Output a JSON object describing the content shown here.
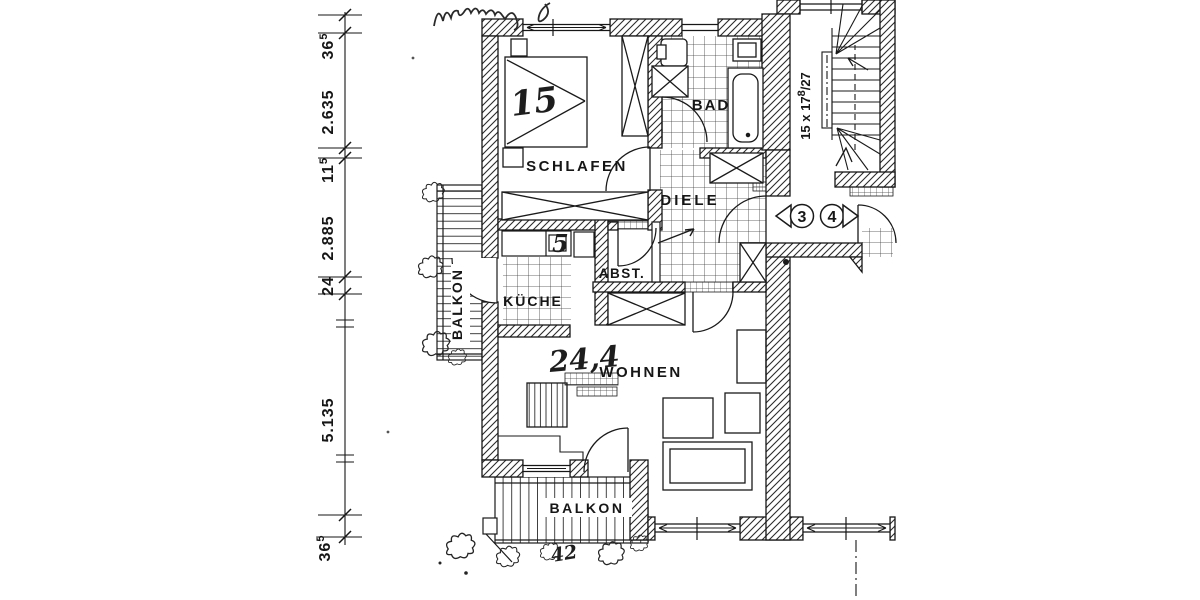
{
  "dimensions": [
    {
      "main": "36",
      "sup": "5"
    },
    {
      "main": "2.635",
      "sup": ""
    },
    {
      "main": "11",
      "sup": "5"
    },
    {
      "main": "2.885",
      "sup": ""
    },
    {
      "main": "24",
      "sup": ""
    },
    {
      "main": "5.135",
      "sup": ""
    },
    {
      "main": "36",
      "sup": "5"
    }
  ],
  "rooms": {
    "schlafen": "SCHLAFEN",
    "bad": "BAD",
    "diele": "DIELE",
    "abst": "ABST.",
    "kueche": "KÜCHE",
    "wohnen": "WOHNEN",
    "balkon_left": "BALKON",
    "balkon_bottom": "BALKON"
  },
  "stairs": {
    "label_main": "15 x 17",
    "label_sup": "8",
    "label_denom": "/27"
  },
  "units": {
    "unit_left": "3",
    "unit_right": "4"
  },
  "annotations": {
    "bed_number": "15",
    "kueche_number": "5",
    "wohnen_area": "24,4",
    "balkon_note": "42"
  }
}
